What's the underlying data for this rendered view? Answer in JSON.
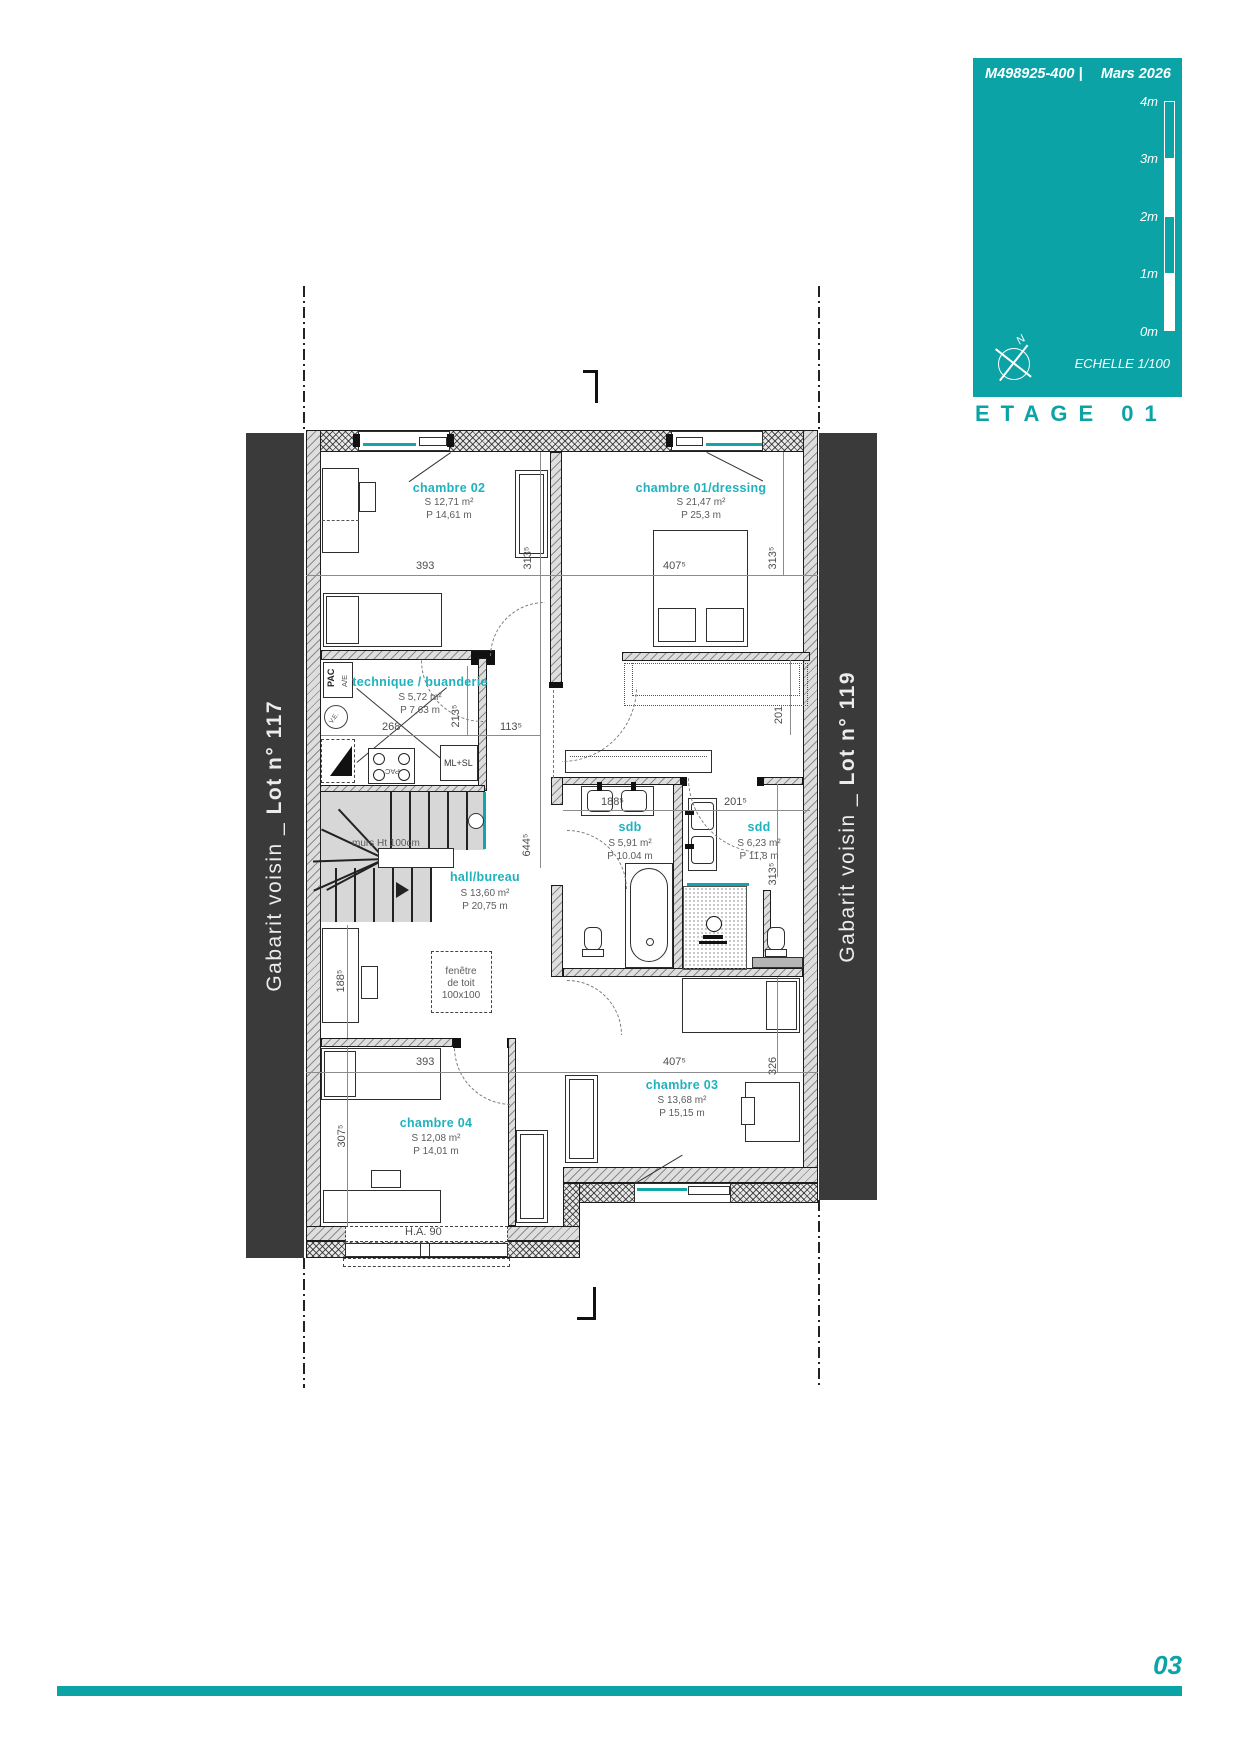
{
  "header": {
    "ref": "M498925-400  |",
    "date": "Mars 2026",
    "scale_label": "ECHELLE  1/100",
    "north": "N",
    "scale_ticks": [
      "4m",
      "3m",
      "2m",
      "1m",
      "0m"
    ],
    "title": "ETAGE 01",
    "page_number": "03"
  },
  "colors": {
    "teal": "#0ba3a6",
    "label_teal": "#1eb2be",
    "strip_gray": "#3a3a3a"
  },
  "neighbors": {
    "left": {
      "normal": "Gabarit voisin _ ",
      "bold": "Lot n° 117"
    },
    "right": {
      "normal": "Gabarit voisin _ ",
      "bold": "Lot n° 119"
    }
  },
  "rooms": [
    {
      "name": "chambre 02",
      "s": "S  12,71 m²",
      "p": "P  14,61 m"
    },
    {
      "name": "chambre 01/dressing",
      "s": "S  21,47 m²",
      "p": "P  25,3 m"
    },
    {
      "name": "technique / buanderie",
      "s": "S  5,72 m²",
      "p": "P  7,63 m"
    },
    {
      "name": "hall/bureau",
      "s": "S  13,60 m²",
      "p": "P  20,75 m"
    },
    {
      "name": "sdb",
      "s": "S  5,91 m²",
      "p": "P  10.04 m"
    },
    {
      "name": "sdd",
      "s": "S  6,23 m²",
      "p": "P  11,8 m"
    },
    {
      "name": "chambre 04",
      "s": "S  12,08 m²",
      "p": "P  14,01 m"
    },
    {
      "name": "chambre 03",
      "s": "S  13,68 m²",
      "p": "P  15,15 m"
    }
  ],
  "dims": {
    "top_left": "393",
    "top_left_v": "313⁵",
    "top_right": "407⁵",
    "top_right_v": "313⁵",
    "tech_w": "268",
    "tech_v": "213⁵",
    "hall_top": "113⁵",
    "hall_v": "644⁵",
    "sdb_w": "188⁵",
    "sdd_w": "201⁵",
    "dress_v": "201",
    "sdd_v": "313⁵",
    "hall_left_v": "188⁵",
    "bot_left": "393",
    "bot_right": "407⁵",
    "ch03_v": "326",
    "ch04_v": "307⁵",
    "window_h": "H.A. 90"
  },
  "annotations": {
    "stair_wall": "murs Ht 100cm",
    "roof_window_1": "fenêtre",
    "roof_window_2": "de toit",
    "roof_window_3": "100x100",
    "ml_sl": "ML+SL",
    "pac": "PAC",
    "pac_sub": "A/E",
    "ve": "V.E.",
    "pac_unit": "PAC"
  }
}
